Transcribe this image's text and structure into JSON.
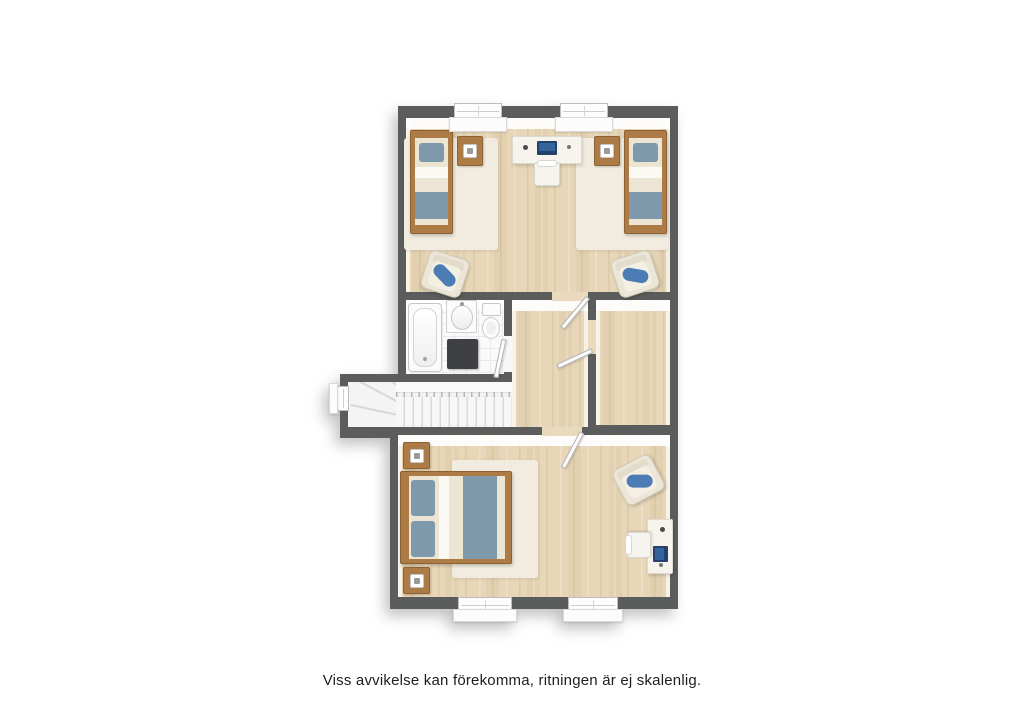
{
  "disclaimer": "Viss avvikelse kan förekomma, ritningen är ej skalenlig.",
  "palette": {
    "wall": "#5b5c5c",
    "wood_flat": "#e9dabd",
    "rug": "#f1ecdf",
    "duvet": "#ece5d3",
    "textile_blue": "#7d99ab",
    "cushion_blue": "#4b7cb4",
    "laptop_blue": "#24416b",
    "furniture_wood": "#ad7c46",
    "furniture_wood_dark": "#8c6133",
    "fixture_white": "#fcfcfc",
    "mat_dark": "#3e4043"
  },
  "plan": {
    "origin": {
      "x": 340,
      "y": 100,
      "w": 340,
      "h": 524
    },
    "base": [
      {
        "name": "walls-upper-block",
        "x": 58,
        "y": 6,
        "w": 280,
        "h": 330
      },
      {
        "name": "walls-lower-block",
        "x": 50,
        "y": 327,
        "w": 288,
        "h": 182
      },
      {
        "name": "walls-stairwell",
        "x": 0,
        "y": 274,
        "w": 172,
        "h": 64
      }
    ],
    "rooms": [
      {
        "name": "bedroom-top",
        "x": 66,
        "y": 18,
        "w": 264,
        "h": 174,
        "floor": "wood"
      },
      {
        "name": "bathroom",
        "x": 66,
        "y": 200,
        "w": 98,
        "h": 74,
        "floor": "tile"
      },
      {
        "name": "hallway",
        "x": 172,
        "y": 200,
        "w": 76,
        "h": 127,
        "floor": "wood"
      },
      {
        "name": "small-room",
        "x": 256,
        "y": 200,
        "w": 74,
        "h": 125,
        "floor": "wood"
      },
      {
        "name": "stair-landing",
        "x": 8,
        "y": 282,
        "w": 164,
        "h": 45,
        "floor": "stair"
      },
      {
        "name": "bedroom-master",
        "x": 58,
        "y": 335,
        "w": 272,
        "h": 162,
        "floor": "wood"
      }
    ],
    "openings": [
      {
        "name": "opening-top-bedroom",
        "x": 212,
        "y": 192,
        "w": 36,
        "h": 9,
        "fill": "wood"
      },
      {
        "name": "opening-small-room",
        "x": 248,
        "y": 220,
        "w": 8,
        "h": 34,
        "fill": "wood"
      },
      {
        "name": "opening-master-bedroom",
        "x": 202,
        "y": 327,
        "w": 40,
        "h": 9,
        "fill": "wood"
      },
      {
        "name": "opening-bathroom",
        "x": 164,
        "y": 236,
        "w": 8,
        "h": 36,
        "fill": "#f7f7f7"
      },
      {
        "name": "opening-stairs-hall",
        "x": 164,
        "y": 282,
        "w": 8,
        "h": 45,
        "fill": "#f1f1f1"
      }
    ],
    "furniture": [
      {
        "type": "rug",
        "name": "rug-top-left",
        "x": 64,
        "y": 38,
        "w": 94,
        "h": 112
      },
      {
        "type": "rug",
        "name": "rug-top-right",
        "x": 236,
        "y": 38,
        "w": 92,
        "h": 112
      },
      {
        "type": "bed_single",
        "name": "single-bed-left",
        "x": 70,
        "y": 30,
        "w": 43,
        "h": 104
      },
      {
        "type": "bed_single",
        "name": "single-bed-right",
        "x": 284,
        "y": 30,
        "w": 43,
        "h": 104
      },
      {
        "type": "nightstand",
        "name": "nightstand-top-left",
        "x": 117,
        "y": 36,
        "w": 26,
        "h": 30
      },
      {
        "type": "nightstand",
        "name": "nightstand-top-right",
        "x": 254,
        "y": 36,
        "w": 26,
        "h": 30
      },
      {
        "type": "desk_h",
        "name": "desk-top-bedroom",
        "x": 172,
        "y": 36,
        "w": 70,
        "h": 28
      },
      {
        "type": "chair_h",
        "name": "desk-chair-top-bedroom",
        "x": 194,
        "y": 62,
        "w": 26,
        "h": 24,
        "rot": 0
      },
      {
        "type": "armchair",
        "name": "armchair-top-left",
        "x": 84,
        "y": 154,
        "w": 42,
        "h": 40,
        "rot": 18
      },
      {
        "type": "armchair",
        "name": "armchair-top-right",
        "x": 274,
        "y": 154,
        "w": 42,
        "h": 40,
        "rot": -18
      },
      {
        "type": "bathtub",
        "name": "bathtub",
        "x": 68,
        "y": 203,
        "w": 34,
        "h": 69
      },
      {
        "type": "sink",
        "name": "sink",
        "x": 106,
        "y": 200,
        "w": 31,
        "h": 33
      },
      {
        "type": "toilet",
        "name": "toilet",
        "x": 141,
        "y": 203,
        "w": 21,
        "h": 37
      },
      {
        "type": "mat",
        "name": "bath-mat",
        "x": 107,
        "y": 239,
        "w": 31,
        "h": 30
      },
      {
        "type": "stairs",
        "name": "staircase",
        "x": 8,
        "y": 282,
        "w": 164,
        "h": 45
      },
      {
        "type": "rug",
        "name": "rug-master",
        "x": 112,
        "y": 360,
        "w": 86,
        "h": 118
      },
      {
        "type": "bed_double",
        "name": "double-bed-master",
        "x": 60,
        "y": 371,
        "w": 112,
        "h": 93
      },
      {
        "type": "nightstand",
        "name": "nightstand-master-top",
        "x": 63,
        "y": 342,
        "w": 27,
        "h": 27
      },
      {
        "type": "nightstand",
        "name": "nightstand-master-bottom",
        "x": 63,
        "y": 467,
        "w": 27,
        "h": 27
      },
      {
        "type": "armchair",
        "name": "armchair-master",
        "x": 277,
        "y": 360,
        "w": 43,
        "h": 40,
        "rot": -28
      },
      {
        "type": "desk_v",
        "name": "desk-master",
        "x": 307,
        "y": 419,
        "w": 26,
        "h": 55
      },
      {
        "type": "chair_h",
        "name": "desk-chair-master",
        "x": 286,
        "y": 433,
        "w": 26,
        "h": 24,
        "rot": -90
      }
    ],
    "doors": [
      {
        "name": "door-top-bedroom",
        "x": 208,
        "y": 195,
        "len": 40,
        "rot": -50
      },
      {
        "name": "door-small-room",
        "x": 214,
        "y": 248,
        "len": 38,
        "rot": -25
      },
      {
        "name": "door-master-bedroom",
        "x": 202,
        "y": 330,
        "len": 40,
        "rot": -62
      },
      {
        "name": "door-bathroom",
        "x": 125,
        "y": 237,
        "len": 39,
        "rot": -78
      }
    ],
    "windows": [
      {
        "name": "window-top-1",
        "x": 114,
        "y": 3,
        "w": 48,
        "h": 16,
        "sill": {
          "x": 109,
          "y": 17,
          "w": 58,
          "h": 15
        }
      },
      {
        "name": "window-top-2",
        "x": 220,
        "y": 3,
        "w": 48,
        "h": 16,
        "sill": {
          "x": 215,
          "y": 17,
          "w": 58,
          "h": 15
        }
      },
      {
        "name": "window-bottom-1",
        "x": 118,
        "y": 497,
        "w": 54,
        "h": 15,
        "sill": {
          "x": 113,
          "y": 509,
          "w": 64,
          "h": 13
        }
      },
      {
        "name": "window-bottom-2",
        "x": 228,
        "y": 497,
        "w": 50,
        "h": 15,
        "sill": {
          "x": 223,
          "y": 509,
          "w": 60,
          "h": 13
        }
      },
      {
        "name": "window-stairs",
        "x": -3,
        "y": 286,
        "w": 12,
        "h": 25,
        "v": true,
        "sill": {
          "x": -11,
          "y": 283,
          "w": 9,
          "h": 31
        }
      }
    ],
    "caption_top": 672
  }
}
